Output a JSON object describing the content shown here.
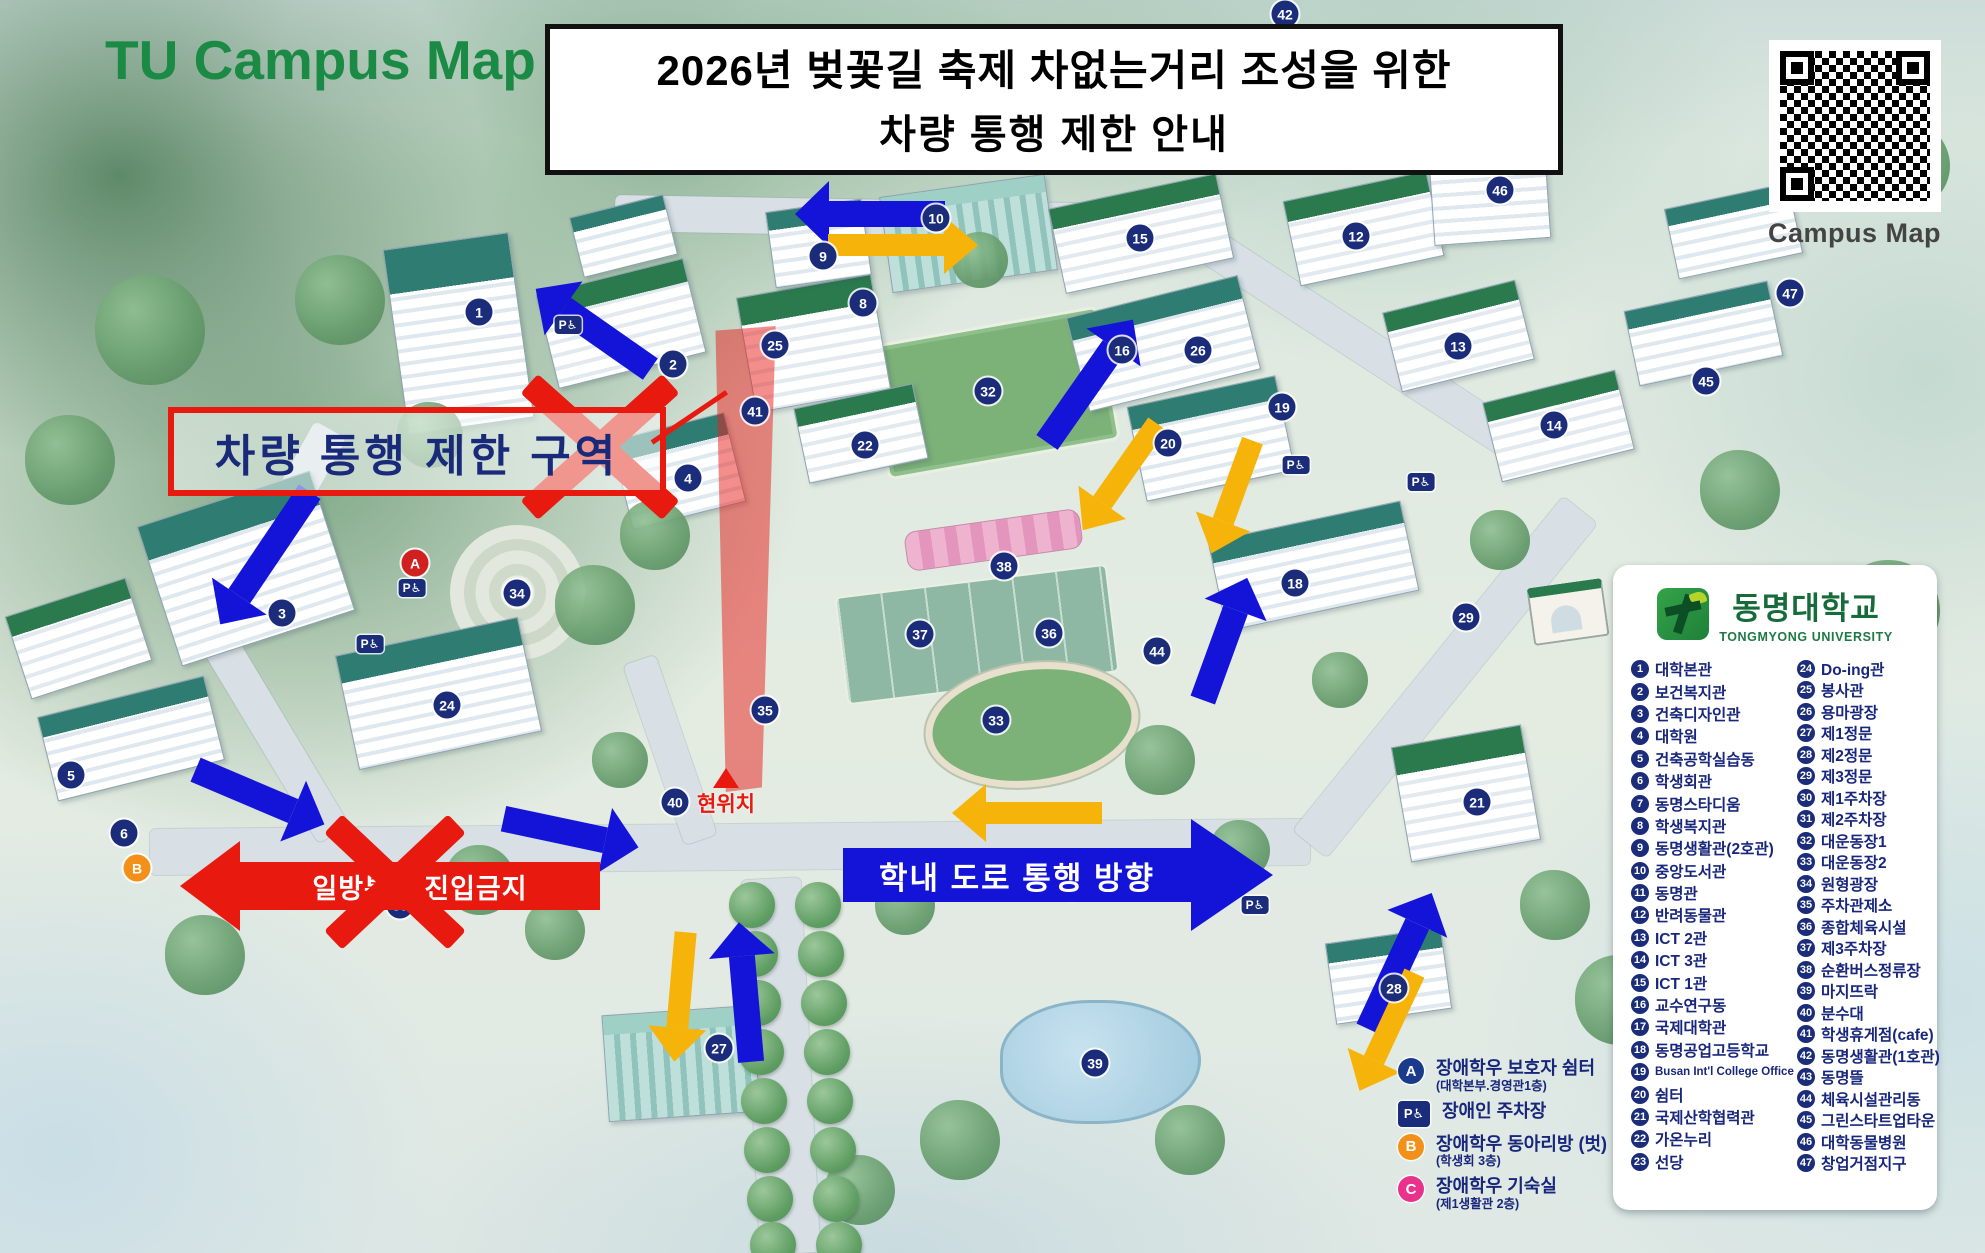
{
  "header": {
    "map_title": "TU Campus Map",
    "banner_line1": "2026년 벚꽃길 축제 차없는거리 조성을 위한",
    "banner_line2": "차량 통행 제한 안내",
    "qr_label": "Campus Map"
  },
  "university": {
    "name_ko": "동명대학교",
    "name_en": "TONGMYONG UNIVERSITY"
  },
  "annotations": {
    "restricted_zone": "차량 통행 제한 구역",
    "one_way_no_entry": "일방통행 진입금지",
    "road_direction": "학내 도로 통행 방향",
    "current_location": "현위치"
  },
  "colors": {
    "accent_red": "#e8190f",
    "arrow_blue": "#1414d8",
    "arrow_yellow": "#f6b40a",
    "title_green": "#1a8a45",
    "legend_navy": "#18277b"
  },
  "legend_buildings": [
    {
      "num": "1",
      "label": "대학본관"
    },
    {
      "num": "2",
      "label": "보건복지관"
    },
    {
      "num": "3",
      "label": "건축디자인관"
    },
    {
      "num": "4",
      "label": "대학원"
    },
    {
      "num": "5",
      "label": "건축공학실습동"
    },
    {
      "num": "6",
      "label": "학생회관"
    },
    {
      "num": "7",
      "label": "동명스타디움"
    },
    {
      "num": "8",
      "label": "학생복지관"
    },
    {
      "num": "9",
      "label": "동명생활관(2호관)"
    },
    {
      "num": "10",
      "label": "중앙도서관"
    },
    {
      "num": "11",
      "label": "동명관"
    },
    {
      "num": "12",
      "label": "반려동물관"
    },
    {
      "num": "13",
      "label": "ICT 2관"
    },
    {
      "num": "14",
      "label": "ICT 3관"
    },
    {
      "num": "15",
      "label": "ICT 1관"
    },
    {
      "num": "16",
      "label": "교수연구동"
    },
    {
      "num": "17",
      "label": "국제대학관"
    },
    {
      "num": "18",
      "label": "동명공업고등학교"
    },
    {
      "num": "19",
      "label": "Busan Int'l College Office"
    },
    {
      "num": "20",
      "label": "쉼터"
    },
    {
      "num": "21",
      "label": "국제산학협력관"
    },
    {
      "num": "22",
      "label": "가온누리"
    },
    {
      "num": "23",
      "label": "선당"
    },
    {
      "num": "24",
      "label": "Do-ing관"
    },
    {
      "num": "25",
      "label": "봉사관"
    },
    {
      "num": "26",
      "label": "용마광장"
    },
    {
      "num": "27",
      "label": "제1정문"
    },
    {
      "num": "28",
      "label": "제2정문"
    },
    {
      "num": "29",
      "label": "제3정문"
    },
    {
      "num": "30",
      "label": "제1주차장"
    },
    {
      "num": "31",
      "label": "제2주차장"
    },
    {
      "num": "32",
      "label": "대운동장1"
    },
    {
      "num": "33",
      "label": "대운동장2"
    },
    {
      "num": "34",
      "label": "원형광장"
    },
    {
      "num": "35",
      "label": "주차관제소"
    },
    {
      "num": "36",
      "label": "종합체육시설"
    },
    {
      "num": "37",
      "label": "제3주차장"
    },
    {
      "num": "38",
      "label": "순환버스정류장"
    },
    {
      "num": "39",
      "label": "마지뜨락"
    },
    {
      "num": "40",
      "label": "분수대"
    },
    {
      "num": "41",
      "label": "학생휴게점(cafe)"
    },
    {
      "num": "42",
      "label": "동명생활관(1호관)"
    },
    {
      "num": "43",
      "label": "동명뜰"
    },
    {
      "num": "44",
      "label": "체육시설관리동"
    },
    {
      "num": "45",
      "label": "그린스타트업타운"
    },
    {
      "num": "46",
      "label": "대학동물병원"
    },
    {
      "num": "47",
      "label": "창업거점지구"
    }
  ],
  "access_legend": [
    {
      "badge": "A",
      "icon": "guardian-shelter-badge",
      "cls": "",
      "color": "#1a3a8c",
      "label": "장애학우 보호자 쉼터",
      "sub": "(대학본부.경영관1층)"
    },
    {
      "badge": "P♿",
      "icon": "disabled-parking-badge",
      "cls": "sq",
      "color": "#1b2d7a",
      "label": "장애인 주차장",
      "sub": ""
    },
    {
      "badge": "B",
      "icon": "club-room-badge",
      "cls": "",
      "color": "#f39019",
      "label": "장애학우 동아리방 (벗)",
      "sub": "(학생회 3층)"
    },
    {
      "badge": "C",
      "icon": "dorm-room-badge",
      "cls": "",
      "color": "#e8328c",
      "label": "장애학우 기숙실",
      "sub": "(제1생활관 2층)"
    }
  ],
  "map": {
    "markers": [
      {
        "n": "1",
        "x": 479,
        "y": 312
      },
      {
        "n": "2",
        "x": 673,
        "y": 364
      },
      {
        "n": "3",
        "x": 282,
        "y": 613
      },
      {
        "n": "4",
        "x": 688,
        "y": 478
      },
      {
        "n": "5",
        "x": 71,
        "y": 775
      },
      {
        "n": "6",
        "x": 124,
        "y": 833
      },
      {
        "n": "8",
        "x": 863,
        "y": 303
      },
      {
        "n": "9",
        "x": 823,
        "y": 256
      },
      {
        "n": "10",
        "x": 936,
        "y": 218
      },
      {
        "n": "12",
        "x": 1356,
        "y": 236
      },
      {
        "n": "13",
        "x": 1458,
        "y": 346
      },
      {
        "n": "14",
        "x": 1554,
        "y": 425
      },
      {
        "n": "15",
        "x": 1140,
        "y": 238
      },
      {
        "n": "16",
        "x": 1122,
        "y": 350
      },
      {
        "n": "18",
        "x": 1295,
        "y": 583
      },
      {
        "n": "19",
        "x": 1282,
        "y": 407
      },
      {
        "n": "20",
        "x": 1168,
        "y": 443
      },
      {
        "n": "21",
        "x": 1477,
        "y": 802
      },
      {
        "n": "22",
        "x": 865,
        "y": 445
      },
      {
        "n": "24",
        "x": 447,
        "y": 705
      },
      {
        "n": "25",
        "x": 775,
        "y": 345
      },
      {
        "n": "26",
        "x": 1198,
        "y": 350
      },
      {
        "n": "27",
        "x": 719,
        "y": 1048
      },
      {
        "n": "28",
        "x": 1394,
        "y": 988
      },
      {
        "n": "29",
        "x": 1466,
        "y": 617
      },
      {
        "n": "30",
        "x": 400,
        "y": 905
      },
      {
        "n": "31",
        "x": 1072,
        "y": 887
      },
      {
        "n": "32",
        "x": 988,
        "y": 391
      },
      {
        "n": "33",
        "x": 996,
        "y": 720
      },
      {
        "n": "34",
        "x": 517,
        "y": 593
      },
      {
        "n": "35",
        "x": 765,
        "y": 710
      },
      {
        "n": "36",
        "x": 1049,
        "y": 633
      },
      {
        "n": "37",
        "x": 920,
        "y": 634
      },
      {
        "n": "38",
        "x": 1004,
        "y": 566
      },
      {
        "n": "39",
        "x": 1095,
        "y": 1063
      },
      {
        "n": "40",
        "x": 675,
        "y": 802
      },
      {
        "n": "41",
        "x": 755,
        "y": 411
      },
      {
        "n": "42",
        "x": 1285,
        "y": 14
      },
      {
        "n": "44",
        "x": 1157,
        "y": 651
      },
      {
        "n": "45",
        "x": 1706,
        "y": 381
      },
      {
        "n": "46",
        "x": 1500,
        "y": 190
      },
      {
        "n": "47",
        "x": 1790,
        "y": 293
      },
      {
        "n": "A",
        "x": 415,
        "y": 563,
        "cls": "red"
      },
      {
        "n": "B",
        "x": 137,
        "y": 868,
        "cls": "org"
      }
    ],
    "parking_badges": [
      {
        "x": 412,
        "y": 588
      },
      {
        "x": 370,
        "y": 644
      },
      {
        "x": 1296,
        "y": 465
      },
      {
        "x": 1421,
        "y": 482
      },
      {
        "x": 1255,
        "y": 905
      },
      {
        "x": 568,
        "y": 325
      }
    ],
    "arrows": [
      {
        "c": "blue",
        "x": 870,
        "y": 207,
        "len": 150,
        "w": 26,
        "a": 180
      },
      {
        "c": "yellow",
        "x": 903,
        "y": 238,
        "len": 150,
        "w": 22,
        "a": 0
      },
      {
        "c": "blue",
        "x": 593,
        "y": 322,
        "len": 140,
        "w": 26,
        "a": 215
      },
      {
        "c": "blue",
        "x": 265,
        "y": 551,
        "len": 160,
        "w": 26,
        "a": 124
      },
      {
        "c": "blue",
        "x": 260,
        "y": 790,
        "len": 140,
        "w": 26,
        "a": 23
      },
      {
        "c": "blue",
        "x": 571,
        "y": 826,
        "len": 138,
        "w": 26,
        "a": 12
      },
      {
        "c": "yellow",
        "x": 680,
        "y": 990,
        "len": 130,
        "w": 22,
        "a": 95
      },
      {
        "c": "blue",
        "x": 745,
        "y": 985,
        "len": 140,
        "w": 26,
        "a": 265
      },
      {
        "c": "blue",
        "x": 1090,
        "y": 374,
        "len": 150,
        "w": 26,
        "a": 305
      },
      {
        "c": "yellow",
        "x": 1120,
        "y": 470,
        "len": 130,
        "w": 22,
        "a": 125
      },
      {
        "c": "blue",
        "x": 1225,
        "y": 632,
        "len": 130,
        "w": 26,
        "a": 290
      },
      {
        "c": "yellow",
        "x": 1232,
        "y": 490,
        "len": 120,
        "w": 22,
        "a": 110
      },
      {
        "c": "blue",
        "x": 1400,
        "y": 954,
        "len": 150,
        "w": 26,
        "a": 295
      },
      {
        "c": "yellow",
        "x": 1387,
        "y": 1025,
        "len": 130,
        "w": 22,
        "a": 115
      },
      {
        "c": "yellow",
        "x": 1027,
        "y": 806,
        "len": 150,
        "w": 22,
        "a": 180
      }
    ],
    "x_marks": [
      {
        "x": 600,
        "y": 447,
        "w": 190,
        "h": 170,
        "s": 26
      },
      {
        "x": 395,
        "y": 882,
        "w": 170,
        "h": 160,
        "s": 26
      }
    ],
    "decor": [
      {
        "t": "road",
        "x": 150,
        "y": 824,
        "w": 1160,
        "h": 46,
        "r": -0.5
      },
      {
        "t": "road",
        "x": 1230,
        "y": 655,
        "w": 430,
        "h": 44,
        "r": -51
      },
      {
        "t": "road",
        "x": 615,
        "y": 200,
        "w": 570,
        "h": 36,
        "r": 1
      },
      {
        "t": "road",
        "x": 1152,
        "y": 322,
        "w": 405,
        "h": 36,
        "r": 33
      },
      {
        "t": "road",
        "x": 157,
        "y": 514,
        "w": 234,
        "h": 36,
        "r": 119
      },
      {
        "t": "road",
        "x": 162,
        "y": 719,
        "w": 227,
        "h": 36,
        "r": 59
      },
      {
        "t": "road",
        "x": 593,
        "y": 1036,
        "w": 375,
        "h": 60,
        "r": 87
      },
      {
        "t": "road",
        "x": 575,
        "y": 733,
        "w": 190,
        "h": 34,
        "r": 71
      },
      {
        "t": "bldg",
        "x": 395,
        "y": 240,
        "w": 125,
        "h": 185,
        "r": -8
      },
      {
        "t": "bldg g",
        "x": 545,
        "y": 275,
        "w": 150,
        "h": 95,
        "r": -14
      },
      {
        "t": "bldg",
        "x": 575,
        "y": 205,
        "w": 95,
        "h": 60,
        "r": -14
      },
      {
        "t": "bldg g",
        "x": 745,
        "y": 285,
        "w": 135,
        "h": 115,
        "r": -10
      },
      {
        "t": "bldg",
        "x": 770,
        "y": 205,
        "w": 95,
        "h": 75,
        "r": -8
      },
      {
        "t": "bldg glass",
        "x": 885,
        "y": 185,
        "w": 165,
        "h": 95,
        "r": -8
      },
      {
        "t": "bldg g",
        "x": 1055,
        "y": 190,
        "w": 170,
        "h": 85,
        "r": -12
      },
      {
        "t": "bldg g",
        "x": 1290,
        "y": 185,
        "w": 145,
        "h": 85,
        "r": -12
      },
      {
        "t": "bldg",
        "x": 1075,
        "y": 295,
        "w": 175,
        "h": 95,
        "r": -14
      },
      {
        "t": "bldg g",
        "x": 1390,
        "y": 295,
        "w": 135,
        "h": 80,
        "r": -14
      },
      {
        "t": "bldg g",
        "x": 1490,
        "y": 385,
        "w": 135,
        "h": 80,
        "r": -14
      },
      {
        "t": "bldg",
        "x": 1135,
        "y": 390,
        "w": 150,
        "h": 95,
        "r": -12
      },
      {
        "t": "bldg",
        "x": 1215,
        "y": 520,
        "w": 195,
        "h": 90,
        "r": -12
      },
      {
        "t": "bldg",
        "x": 1430,
        "y": 115,
        "w": 115,
        "h": 125,
        "r": -4
      },
      {
        "t": "bldg",
        "x": 1630,
        "y": 295,
        "w": 145,
        "h": 75,
        "r": -12
      },
      {
        "t": "bldg",
        "x": 1670,
        "y": 195,
        "w": 125,
        "h": 70,
        "r": -12
      },
      {
        "t": "bldg",
        "x": 155,
        "y": 495,
        "w": 180,
        "h": 145,
        "r": -18
      },
      {
        "t": "bldg",
        "x": 345,
        "y": 635,
        "w": 185,
        "h": 115,
        "r": -12
      },
      {
        "t": "bldg g",
        "x": 15,
        "y": 595,
        "w": 125,
        "h": 85,
        "r": -18
      },
      {
        "t": "bldg",
        "x": 45,
        "y": 695,
        "w": 170,
        "h": 85,
        "r": -14
      },
      {
        "t": "bldg g",
        "x": 800,
        "y": 395,
        "w": 120,
        "h": 75,
        "r": -12
      },
      {
        "t": "bldg",
        "x": 620,
        "y": 425,
        "w": 115,
        "h": 90,
        "r": -14
      },
      {
        "t": "bldg g",
        "x": 1400,
        "y": 735,
        "w": 130,
        "h": 115,
        "r": -10
      },
      {
        "t": "bldg",
        "x": 1330,
        "y": 935,
        "w": 115,
        "h": 80,
        "r": -8
      },
      {
        "t": "bldg glass",
        "x": 605,
        "y": 1010,
        "w": 150,
        "h": 105,
        "r": -4
      },
      {
        "t": "field",
        "x": 875,
        "y": 325,
        "w": 230,
        "h": 130,
        "r": -10
      },
      {
        "t": "tennis",
        "x": 840,
        "y": 580,
        "w": 270,
        "h": 105,
        "r": -7
      },
      {
        "t": "track",
        "x": 925,
        "y": 663,
        "w": 200,
        "h": 110,
        "r": -7
      },
      {
        "t": "plaza",
        "x": 450,
        "y": 525,
        "w": 135,
        "h": 135,
        "r": 0
      },
      {
        "t": "pond",
        "x": 1000,
        "y": 1000,
        "w": 195,
        "h": 118,
        "r": 0
      },
      {
        "t": "flower",
        "x": 905,
        "y": 520,
        "w": 175,
        "h": 38,
        "r": -8
      },
      {
        "t": "arch",
        "x": 1530,
        "y": 583,
        "w": 72,
        "h": 46,
        "r": -8
      },
      {
        "t": "tree",
        "x": 620,
        "y": 500,
        "w": 70,
        "h": 70
      },
      {
        "t": "tree",
        "x": 555,
        "y": 565,
        "w": 80,
        "h": 80
      },
      {
        "t": "tree",
        "x": 875,
        "y": 875,
        "w": 60,
        "h": 60
      },
      {
        "t": "tree",
        "x": 1125,
        "y": 725,
        "w": 70,
        "h": 70
      },
      {
        "t": "tree",
        "x": 1210,
        "y": 820,
        "w": 60,
        "h": 60
      },
      {
        "t": "tree",
        "x": 445,
        "y": 845,
        "w": 70,
        "h": 70
      },
      {
        "t": "tree",
        "x": 525,
        "y": 900,
        "w": 60,
        "h": 60
      },
      {
        "t": "tree",
        "x": 165,
        "y": 915,
        "w": 80,
        "h": 80
      },
      {
        "t": "tree",
        "x": 1520,
        "y": 870,
        "w": 70,
        "h": 70
      },
      {
        "t": "tree",
        "x": 1575,
        "y": 955,
        "w": 90,
        "h": 90
      },
      {
        "t": "tree",
        "x": 920,
        "y": 1100,
        "w": 80,
        "h": 80
      },
      {
        "t": "tree",
        "x": 825,
        "y": 1155,
        "w": 70,
        "h": 70
      },
      {
        "t": "tree",
        "x": 1155,
        "y": 1105,
        "w": 70,
        "h": 70
      },
      {
        "t": "tree",
        "x": 592,
        "y": 732,
        "w": 56,
        "h": 56
      },
      {
        "t": "tree",
        "x": 397,
        "y": 402,
        "w": 66,
        "h": 66
      },
      {
        "t": "tree",
        "x": 1470,
        "y": 510,
        "w": 60,
        "h": 60
      },
      {
        "t": "tree",
        "x": 1312,
        "y": 652,
        "w": 56,
        "h": 56
      },
      {
        "t": "tree",
        "x": 952,
        "y": 232,
        "w": 56,
        "h": 56
      },
      {
        "t": "tree",
        "x": 1240,
        "y": 90,
        "w": 60,
        "h": 60
      },
      {
        "t": "tree",
        "x": 725,
        "y": 85,
        "w": 70,
        "h": 70
      },
      {
        "t": "tree",
        "x": 295,
        "y": 255,
        "w": 90,
        "h": 90
      },
      {
        "t": "tree",
        "x": 95,
        "y": 275,
        "w": 110,
        "h": 110
      },
      {
        "t": "tree",
        "x": 25,
        "y": 415,
        "w": 90,
        "h": 90
      },
      {
        "t": "tree",
        "x": 1700,
        "y": 450,
        "w": 80,
        "h": 80
      },
      {
        "t": "tree",
        "x": 1840,
        "y": 560,
        "w": 100,
        "h": 100
      },
      {
        "t": "tree",
        "x": 1860,
        "y": 120,
        "w": 90,
        "h": 90
      },
      {
        "t": "bush",
        "x": 729,
        "y": 882
      },
      {
        "t": "bush",
        "x": 795,
        "y": 882
      },
      {
        "t": "bush",
        "x": 732,
        "y": 931
      },
      {
        "t": "bush",
        "x": 798,
        "y": 931
      },
      {
        "t": "bush",
        "x": 735,
        "y": 980
      },
      {
        "t": "bush",
        "x": 801,
        "y": 980
      },
      {
        "t": "bush",
        "x": 738,
        "y": 1029
      },
      {
        "t": "bush",
        "x": 804,
        "y": 1029
      },
      {
        "t": "bush",
        "x": 741,
        "y": 1078
      },
      {
        "t": "bush",
        "x": 807,
        "y": 1078
      },
      {
        "t": "bush",
        "x": 744,
        "y": 1127
      },
      {
        "t": "bush",
        "x": 810,
        "y": 1127
      },
      {
        "t": "bush",
        "x": 747,
        "y": 1176
      },
      {
        "t": "bush",
        "x": 813,
        "y": 1176
      },
      {
        "t": "bush",
        "x": 750,
        "y": 1222
      },
      {
        "t": "bush",
        "x": 816,
        "y": 1222
      }
    ]
  }
}
